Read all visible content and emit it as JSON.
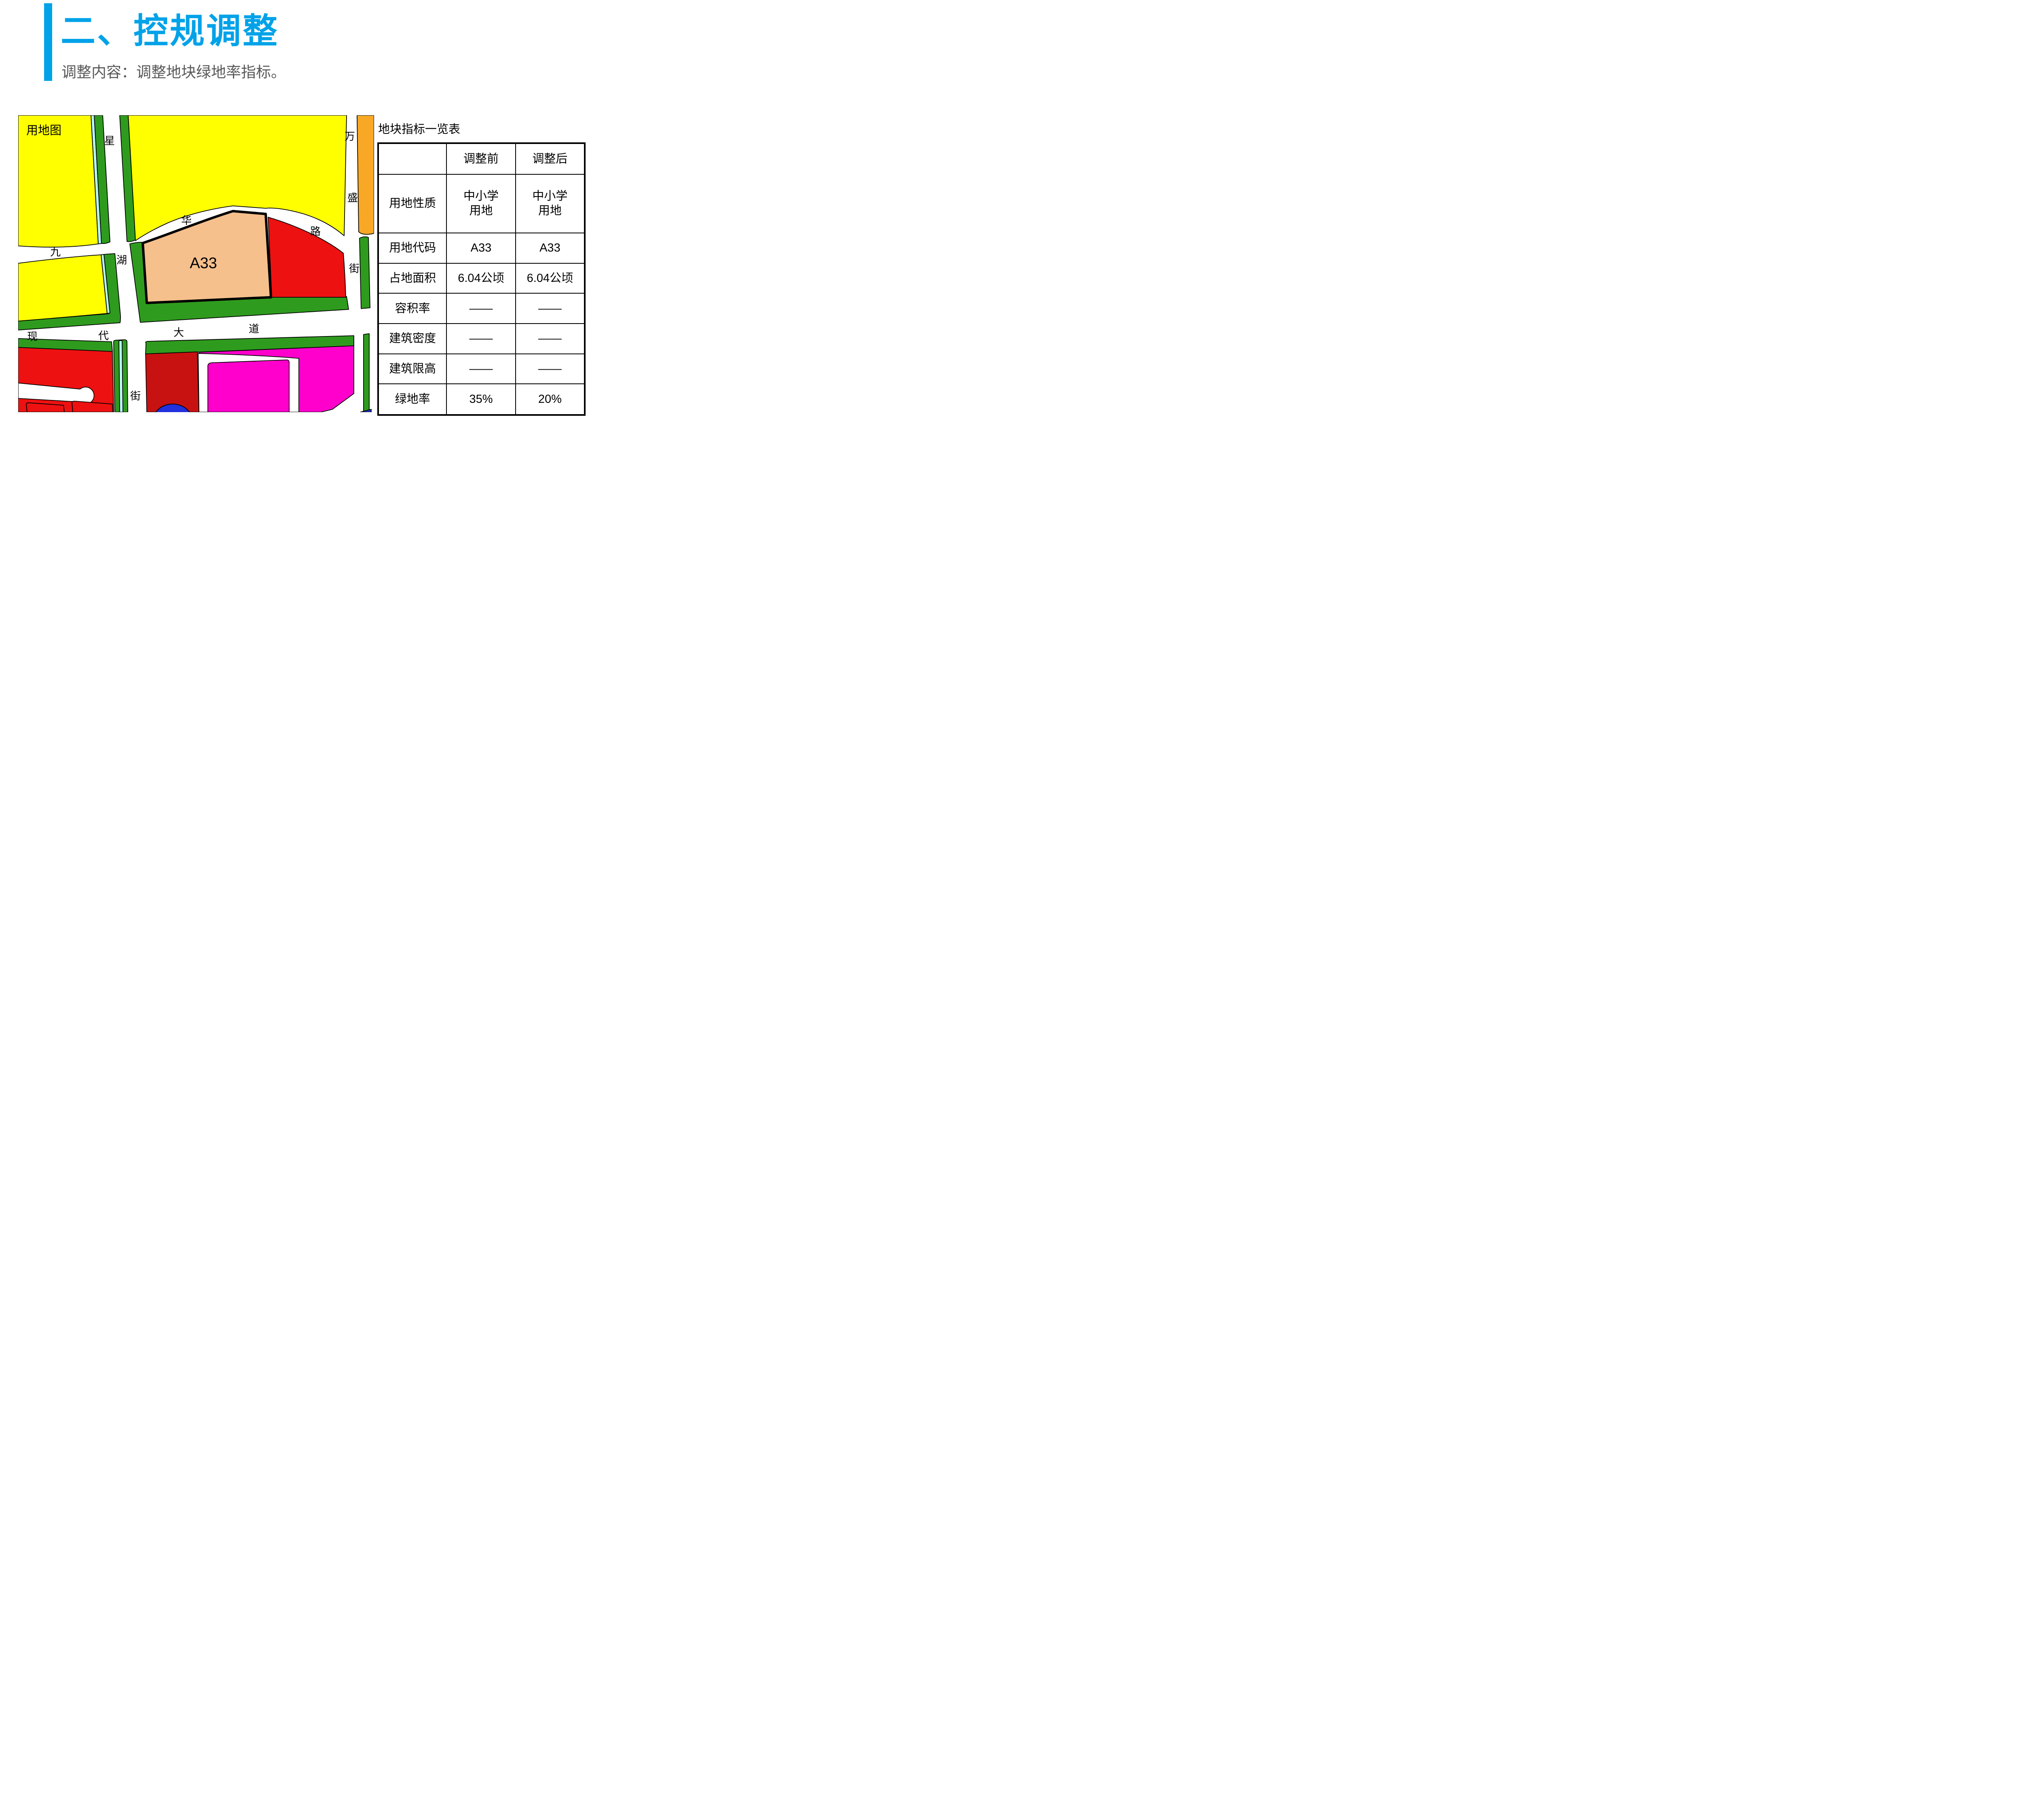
{
  "slide": {
    "title": "二、控规调整",
    "subtitle": "调整内容：调整地块绿地率指标。",
    "accent_color": "#00A2E8",
    "subtitle_color": "#595959"
  },
  "map": {
    "corner_label": "用地图",
    "parcel_code": "A33",
    "road_labels": [
      {
        "id": "xinghu-1",
        "text": "星"
      },
      {
        "id": "xinghu-2",
        "text": "湖"
      },
      {
        "id": "xinghu-3",
        "text": "街"
      },
      {
        "id": "jiuhua-1",
        "text": "九"
      },
      {
        "id": "jiuhua-2",
        "text": "华"
      },
      {
        "id": "jiuhua-3",
        "text": "路"
      },
      {
        "id": "wansheng-1",
        "text": "万"
      },
      {
        "id": "wansheng-2",
        "text": "盛"
      },
      {
        "id": "wansheng-3",
        "text": "街"
      },
      {
        "id": "xiandai-1",
        "text": "现"
      },
      {
        "id": "xiandai-2",
        "text": "代"
      },
      {
        "id": "xiandai-3",
        "text": "大"
      },
      {
        "id": "xiandai-4",
        "text": "道"
      }
    ],
    "zone_colors": {
      "yellow": "#FFFF00",
      "green": "#2F9B1E",
      "cyan_stripe": "#B6F6F2",
      "red": "#EE1111",
      "dark_red": "#C81212",
      "magenta": "#FF00CC",
      "orange": "#F9A826",
      "tan_highlight": "#F5C08C",
      "blue": "#2230DD",
      "road_white": "#FFFFFF",
      "outline": "#000000"
    }
  },
  "table": {
    "title": "地块指标一览表",
    "columns": [
      "",
      "调整前",
      "调整后"
    ],
    "rows": [
      {
        "label": "用地性质",
        "before": "中小学\n用地",
        "after": "中小学\n用地"
      },
      {
        "label": "用地代码",
        "before": "A33",
        "after": "A33"
      },
      {
        "label": "占地面积",
        "before": "6.04公顷",
        "after": "6.04公顷"
      },
      {
        "label": "容积率",
        "before": "——",
        "after": "——"
      },
      {
        "label": "建筑密度",
        "before": "——",
        "after": "——"
      },
      {
        "label": "建筑限高",
        "before": "——",
        "after": "——"
      },
      {
        "label": "绿地率",
        "before": "35%",
        "after": "20%"
      }
    ],
    "highlight_color": "#FF0000"
  }
}
